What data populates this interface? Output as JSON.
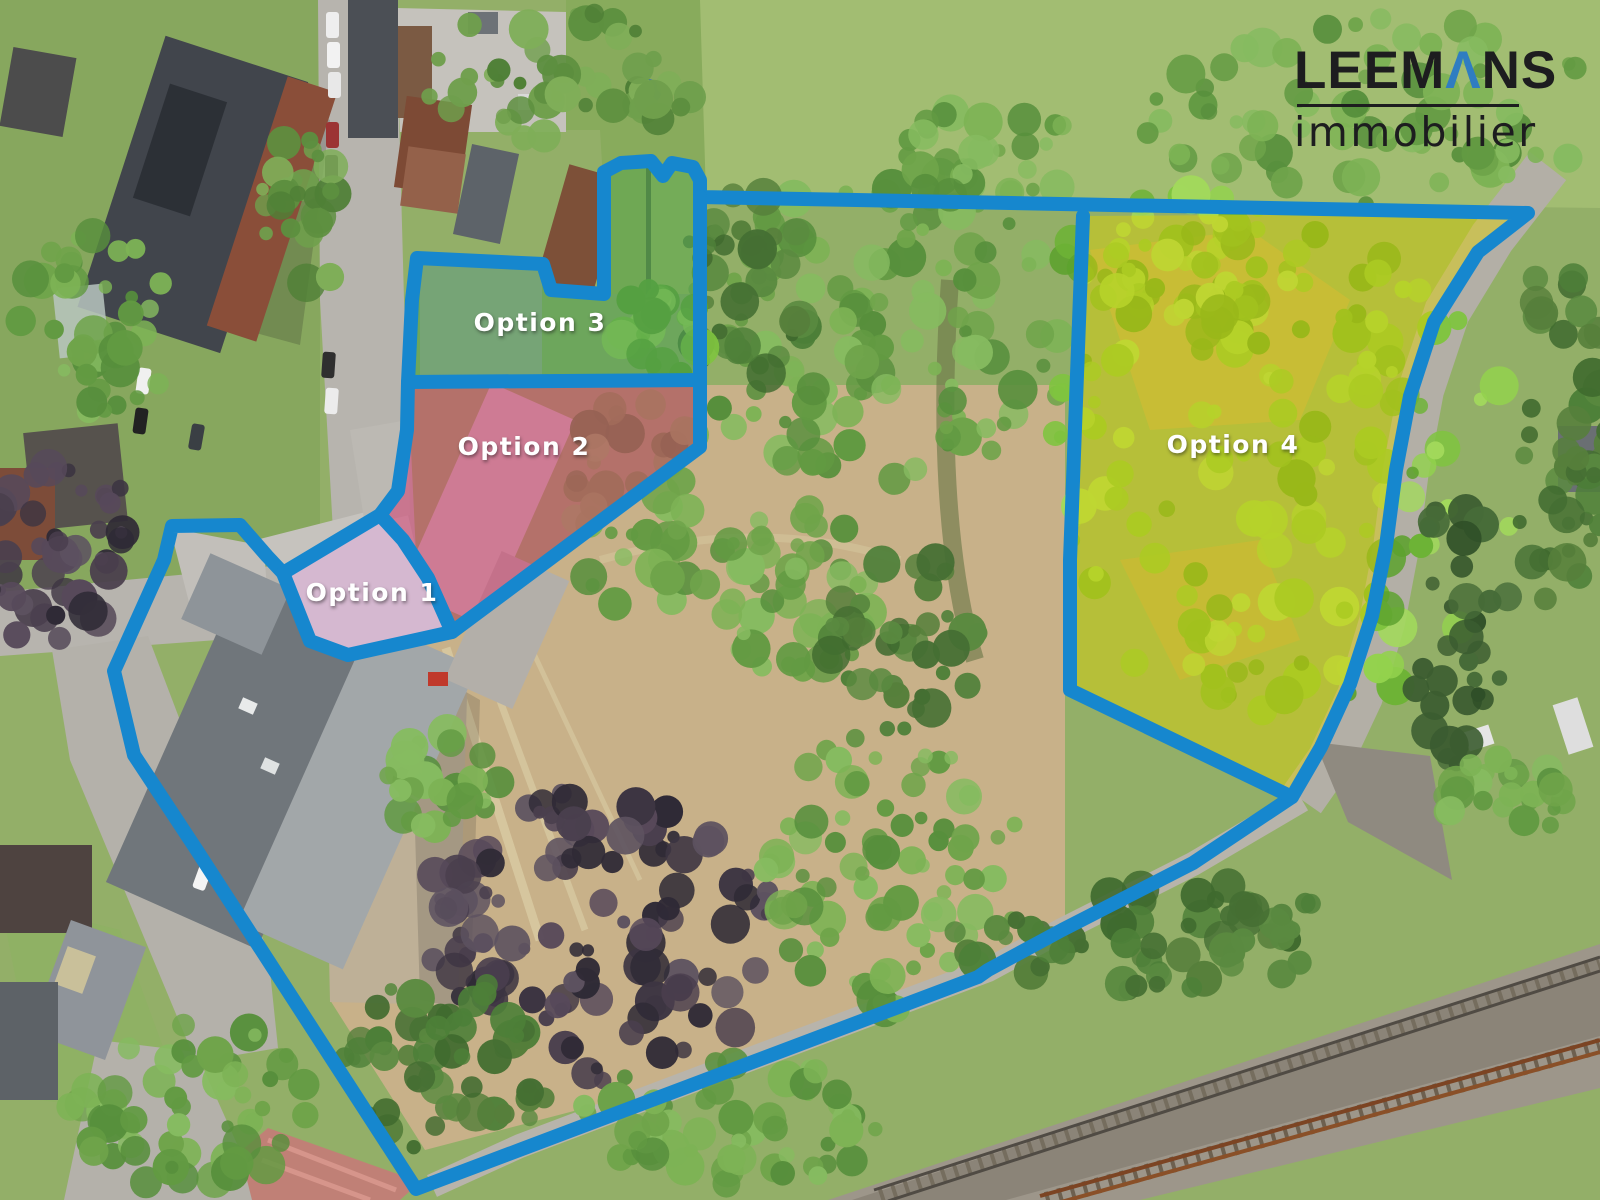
{
  "logo": {
    "brand_main": "LEEMANS",
    "brand_parts": {
      "left": "LEEM",
      "accent": "Λ",
      "right": "NS"
    },
    "brand_sub": "immobilier",
    "accent_color": "#2f7dc1",
    "text_color": "#1d1d1f"
  },
  "map": {
    "boundary_color": "#1687ce",
    "label_color": "#ffffff",
    "zones": [
      {
        "label": "Option 1",
        "fill": "#dcaed6"
      },
      {
        "label": "Option 2",
        "fill": "#d6336c"
      },
      {
        "label": "Option 3",
        "fill": "#4e9e52"
      },
      {
        "label": "Option 4",
        "fill": "#e3d200"
      }
    ]
  }
}
